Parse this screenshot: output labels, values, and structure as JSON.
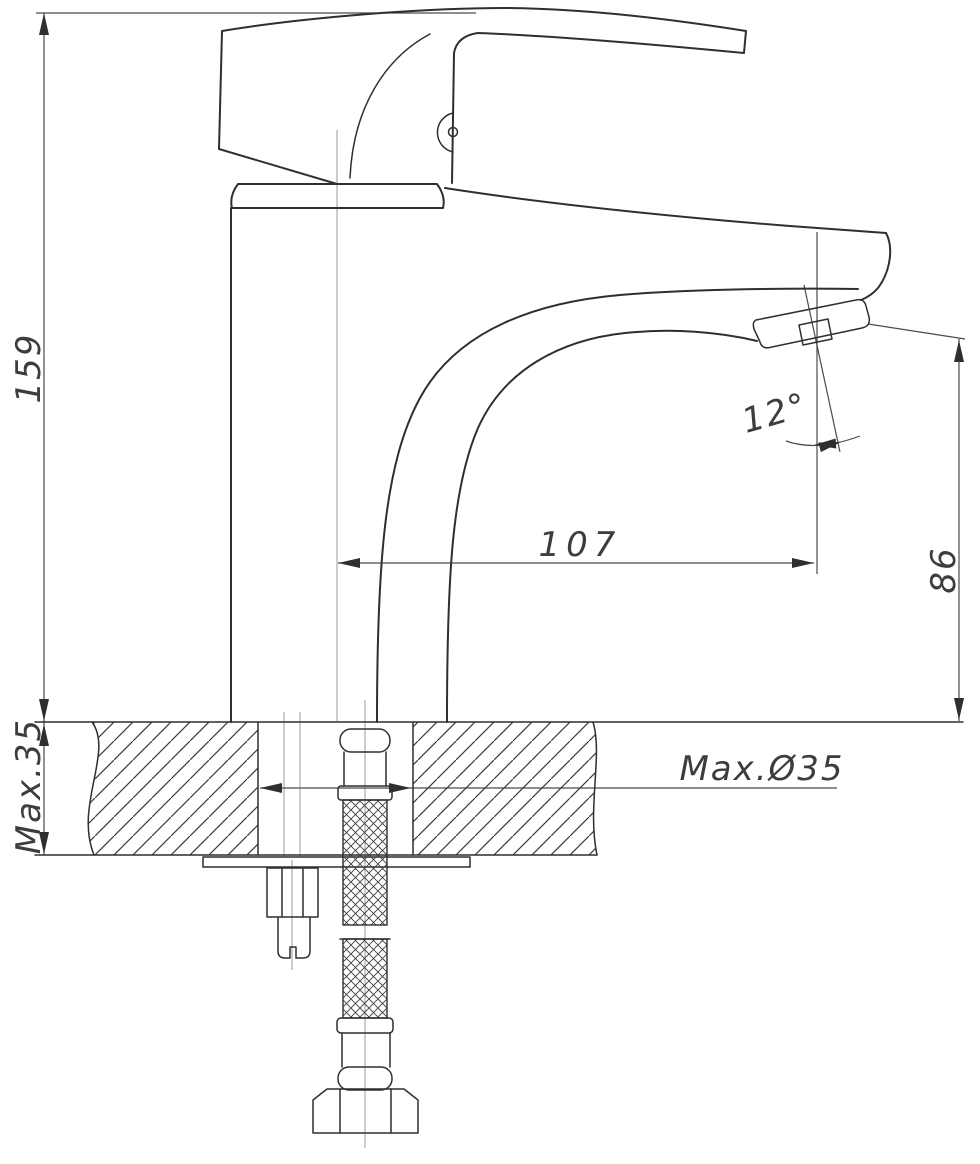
{
  "drawing": {
    "labels": {
      "total_height": "159",
      "spout_reach": "107",
      "outlet_height": "86",
      "outlet_angle": "12°",
      "deck_thickness": "Max.35",
      "hole_diameter": "Max.Ø35"
    },
    "colors": {
      "background": "#ffffff",
      "outline": "#2f2f2f",
      "dimension_line": "#4a4a4a",
      "center_line": "#9b9b9b",
      "text": "#3d3d3d"
    }
  }
}
